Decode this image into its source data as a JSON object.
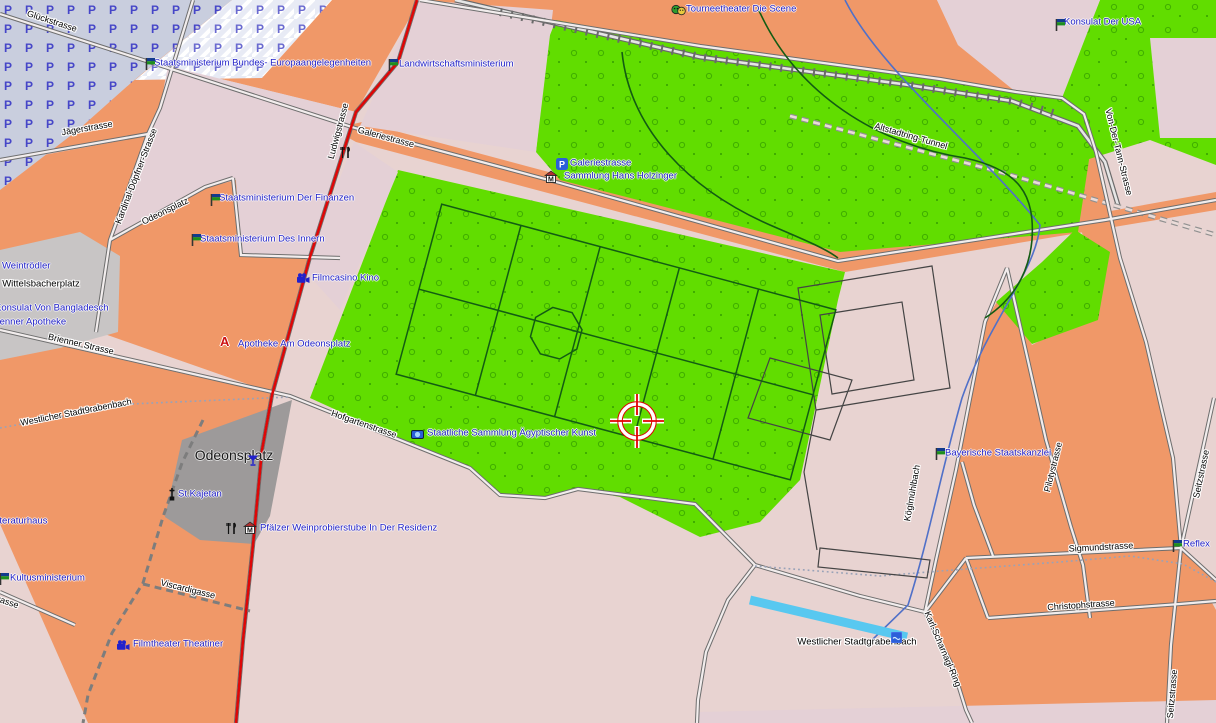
{
  "map": {
    "parking_glyph": "P",
    "museum_glyph": "M",
    "pharmacy_glyph": "A",
    "colors": {
      "land_pink": "#e8d3d1",
      "urban_orange": "#f09868",
      "park_green": "#61dd00",
      "park_dot_green": "#3fae00",
      "plaza_gray": "#9d9a9a",
      "square_gray": "#c8c5c5",
      "parking_fill": "#c9cede",
      "street_casing": "#6e6e6e",
      "main_road_red": "#dd0707",
      "water_blue": "#58c8f0",
      "stream_blue": "#5070c8",
      "poi_text_blue": "#1f1fc8",
      "path_green_dark": "#135c13"
    },
    "street_labels": [
      {
        "label": "Glückstrasse"
      },
      {
        "label": "Jägerstrasse"
      },
      {
        "label": "Kardinal-Döpfner-Strasse"
      },
      {
        "label": "Ludwigstrasse"
      },
      {
        "label": "Odeonsplatz"
      },
      {
        "label": "Galeriestrasse"
      },
      {
        "label": "Altstadtring-Tunnel"
      },
      {
        "label": "Von-Der-Tann-Strasse"
      },
      {
        "label": "Brienner Strasse"
      },
      {
        "label": "Westlicher Stadt9rabenbach"
      },
      {
        "label": "Hofgartenstrasse"
      },
      {
        "label": "Viscardigasse"
      },
      {
        "label": "Sigmundstrasse"
      },
      {
        "label": "Christophstrasse"
      },
      {
        "label": "Seitzstrasse"
      },
      {
        "label": "Seitzstrasse"
      },
      {
        "label": "Karl-Scharnagl-Ring"
      },
      {
        "label": "Köglmühlbach"
      },
      {
        "label": "Pilotystrasse"
      },
      {
        "label": "rasse"
      }
    ],
    "area_labels": [
      {
        "label": "Wittelsbacherplatz"
      },
      {
        "label": "Odeonsplatz"
      },
      {
        "label": "Westlicher Stadtgrabenbach"
      }
    ],
    "poi_labels": [
      {
        "label": "Staatsministerium Bundes- Europaangelegenheiten",
        "icon": "flag"
      },
      {
        "label": "Landwirtschaftsministerium",
        "icon": "flag"
      },
      {
        "label": "Tourneetheater Die Scene",
        "icon": "theater"
      },
      {
        "label": "Konsulat Der USA",
        "icon": "flag"
      },
      {
        "label": "Staatsministerium Der Finanzen",
        "icon": "flag"
      },
      {
        "label": "Staatsministerium Des Innern",
        "icon": "flag"
      },
      {
        "label": "Weintrödler",
        "icon": "none"
      },
      {
        "label": "Konsulat Von Bangladesch",
        "icon": "none"
      },
      {
        "label": "Brienner Apotheke",
        "icon": "none"
      },
      {
        "label": "Filmcasino Kino",
        "icon": "cinema"
      },
      {
        "label": "Apotheke Am Odeonsplatz",
        "icon": "pharmacy"
      },
      {
        "label": "Galeriestrasse",
        "icon": "parking"
      },
      {
        "label": "Sammlung Hans Holzinger",
        "icon": "museum"
      },
      {
        "label": "Staatliche Sammlung Ägyptischer Kunst",
        "icon": "attraction"
      },
      {
        "label": "Literaturhaus",
        "icon": "none"
      },
      {
        "label": "St.Kajetan",
        "icon": "church"
      },
      {
        "label": "Pfälzer Weinprobierstube In Der Residenz",
        "icon": "restaurant-museum"
      },
      {
        "label": "Kultusministerium",
        "icon": "flag"
      },
      {
        "label": "Filmtheater Theatiner",
        "icon": "cinema"
      },
      {
        "label": "Bayerische Staatskanzlei",
        "icon": "flag"
      },
      {
        "label": "Reflex",
        "icon": "flag"
      }
    ],
    "standalone_icons": [
      {
        "icon": "restaurant"
      },
      {
        "icon": "bar"
      },
      {
        "icon": "water"
      }
    ]
  }
}
